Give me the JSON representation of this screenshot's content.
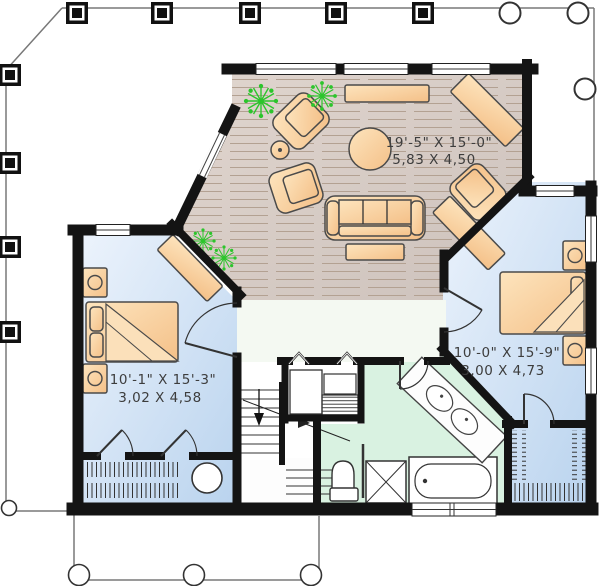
{
  "plan": {
    "type": "floor-plan",
    "rooms": {
      "living": {
        "imperial": "19'-5\" X 15'-0\"",
        "metric": "5,83 X 4,50"
      },
      "bedroom_left": {
        "imperial": "10'-1\" X 15'-3\"",
        "metric": "3,02 X 4,58"
      },
      "bedroom_right": {
        "imperial": "10'-0\" X 15'-9\"",
        "metric": "3,00 X 4,73"
      }
    },
    "colors": {
      "wall": "#141414",
      "bedroom_floor": "#c9dcf1",
      "living_floor": "#d6ccc6",
      "bath_floor": "#d9f2e1",
      "furniture": "#f8cf9e",
      "plant": "#2cc52c",
      "deck_line": "#787878"
    }
  }
}
